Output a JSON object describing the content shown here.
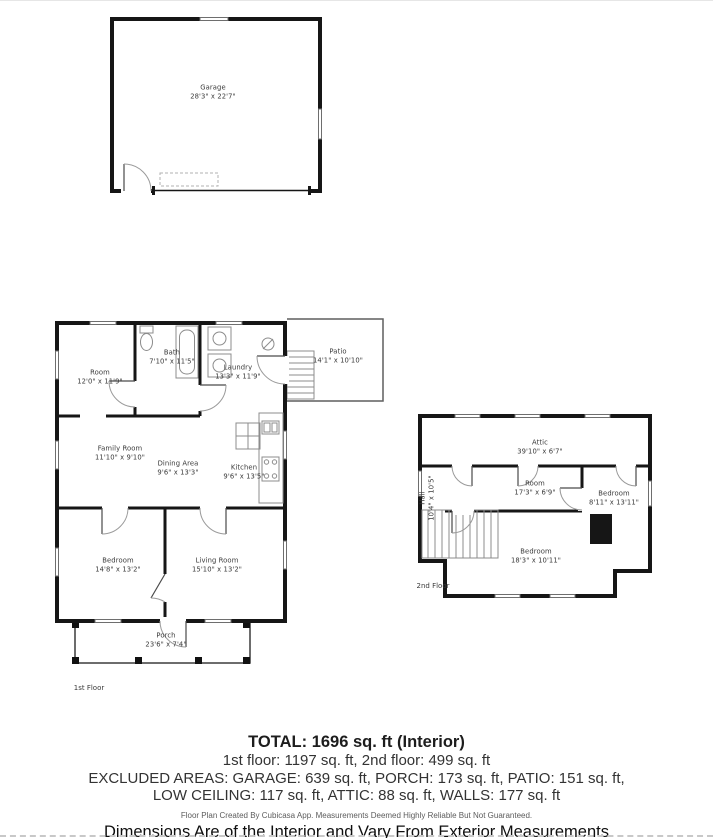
{
  "plans": {
    "garage": {
      "rooms": [
        {
          "name": "Garage",
          "dims": "28'3\" x 22'7\""
        }
      ]
    },
    "first_floor": {
      "floor_label": "1st Floor",
      "rooms": [
        {
          "name": "Room",
          "dims": "12'0\" x 11'9\""
        },
        {
          "name": "Bath",
          "dims": "7'10\" x 11'5\""
        },
        {
          "name": "Laundry",
          "dims": "13'3\" x 11'9\""
        },
        {
          "name": "Patio",
          "dims": "14'1\" x 10'10\""
        },
        {
          "name": "Family Room",
          "dims": "11'10\" x 9'10\""
        },
        {
          "name": "Dining Area",
          "dims": "9'6\" x 13'3\""
        },
        {
          "name": "Kitchen",
          "dims": "9'6\" x 13'5\""
        },
        {
          "name": "Bedroom",
          "dims": "14'8\" x 13'2\""
        },
        {
          "name": "Living Room",
          "dims": "15'10\" x 13'2\""
        },
        {
          "name": "Porch",
          "dims": "23'6\" x 7'4\""
        }
      ]
    },
    "second_floor": {
      "floor_label": "2nd Floor",
      "rooms": [
        {
          "name": "Attic",
          "dims": "39'10\" x 6'7\""
        },
        {
          "name": "Room",
          "dims": "17'3\" x 6'9\""
        },
        {
          "name": "Bedroom",
          "dims": "8'11\" x 13'11\""
        },
        {
          "name": "Hall",
          "dims": "10'4\" x 10'5\""
        },
        {
          "name": "Bedroom",
          "dims": "18'3\" x 10'11\""
        }
      ]
    }
  },
  "summary": {
    "total": "TOTAL: 1696 sq. ft (Interior)",
    "floors": "1st floor: 1197 sq. ft, 2nd floor: 499 sq. ft",
    "excluded_line1": "EXCLUDED AREAS: GARAGE: 639 sq. ft, PORCH: 173 sq. ft, PATIO: 151 sq. ft,",
    "excluded_line2": "LOW CEILING: 117 sq. ft, ATTIC: 88 sq. ft, WALLS: 177 sq. ft",
    "disclaimer": "Floor Plan Created By Cubicasa App. Measurements Deemed Highly Reliable But Not Guaranteed.",
    "dimensions_note": "Dimensions Are of the Interior and Vary From Exterior Measurements"
  },
  "colors": {
    "wall": "#161616",
    "fixture": "#8c8c8c",
    "label_text": "#3a3a3a",
    "summary_text": "#333333",
    "dashed_border": "#c8c8c8"
  }
}
